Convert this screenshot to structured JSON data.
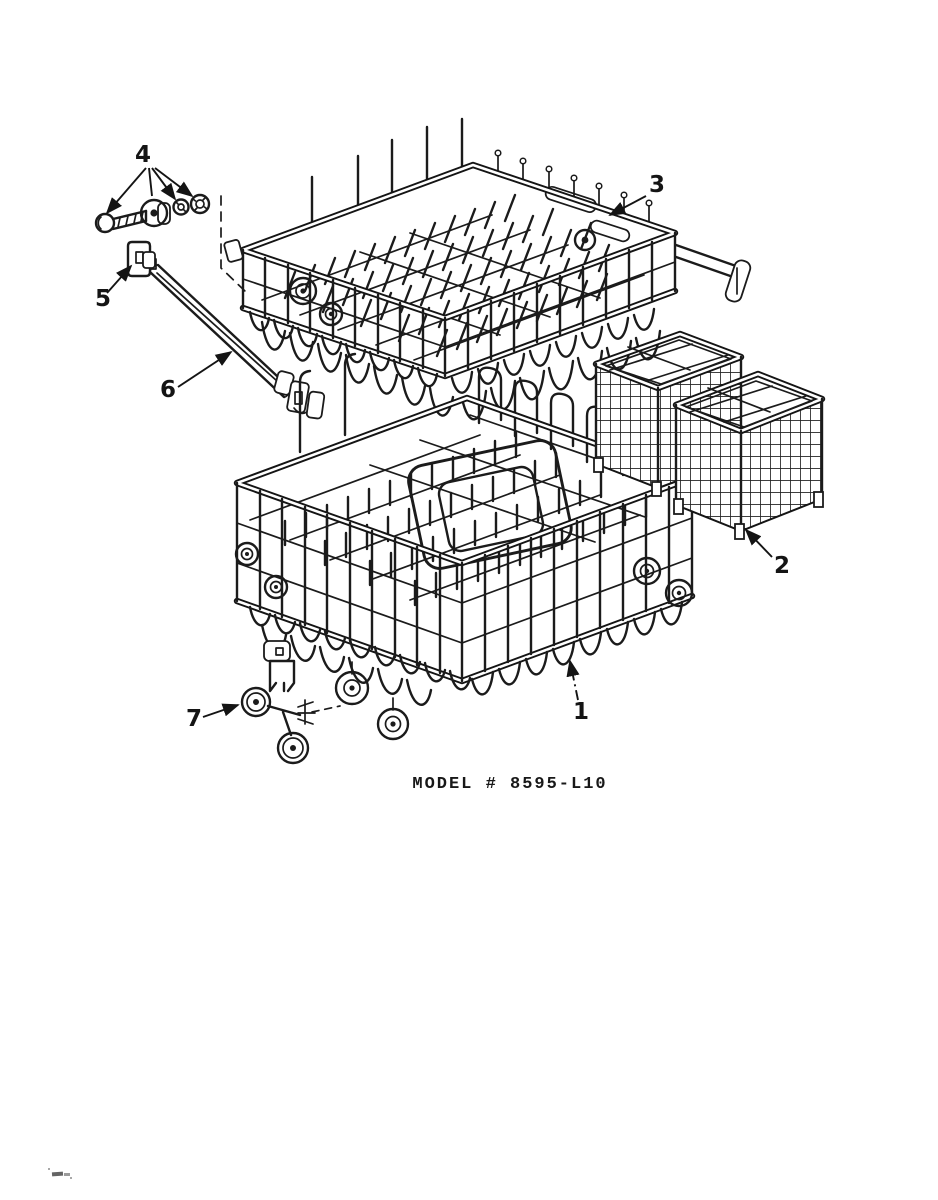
{
  "diagram": {
    "model_label": "MODEL # 8595-L10",
    "callouts": {
      "c1": "1",
      "c2": "2",
      "c3": "3",
      "c4": "4",
      "c5": "5",
      "c6": "6",
      "c7": "7"
    }
  }
}
